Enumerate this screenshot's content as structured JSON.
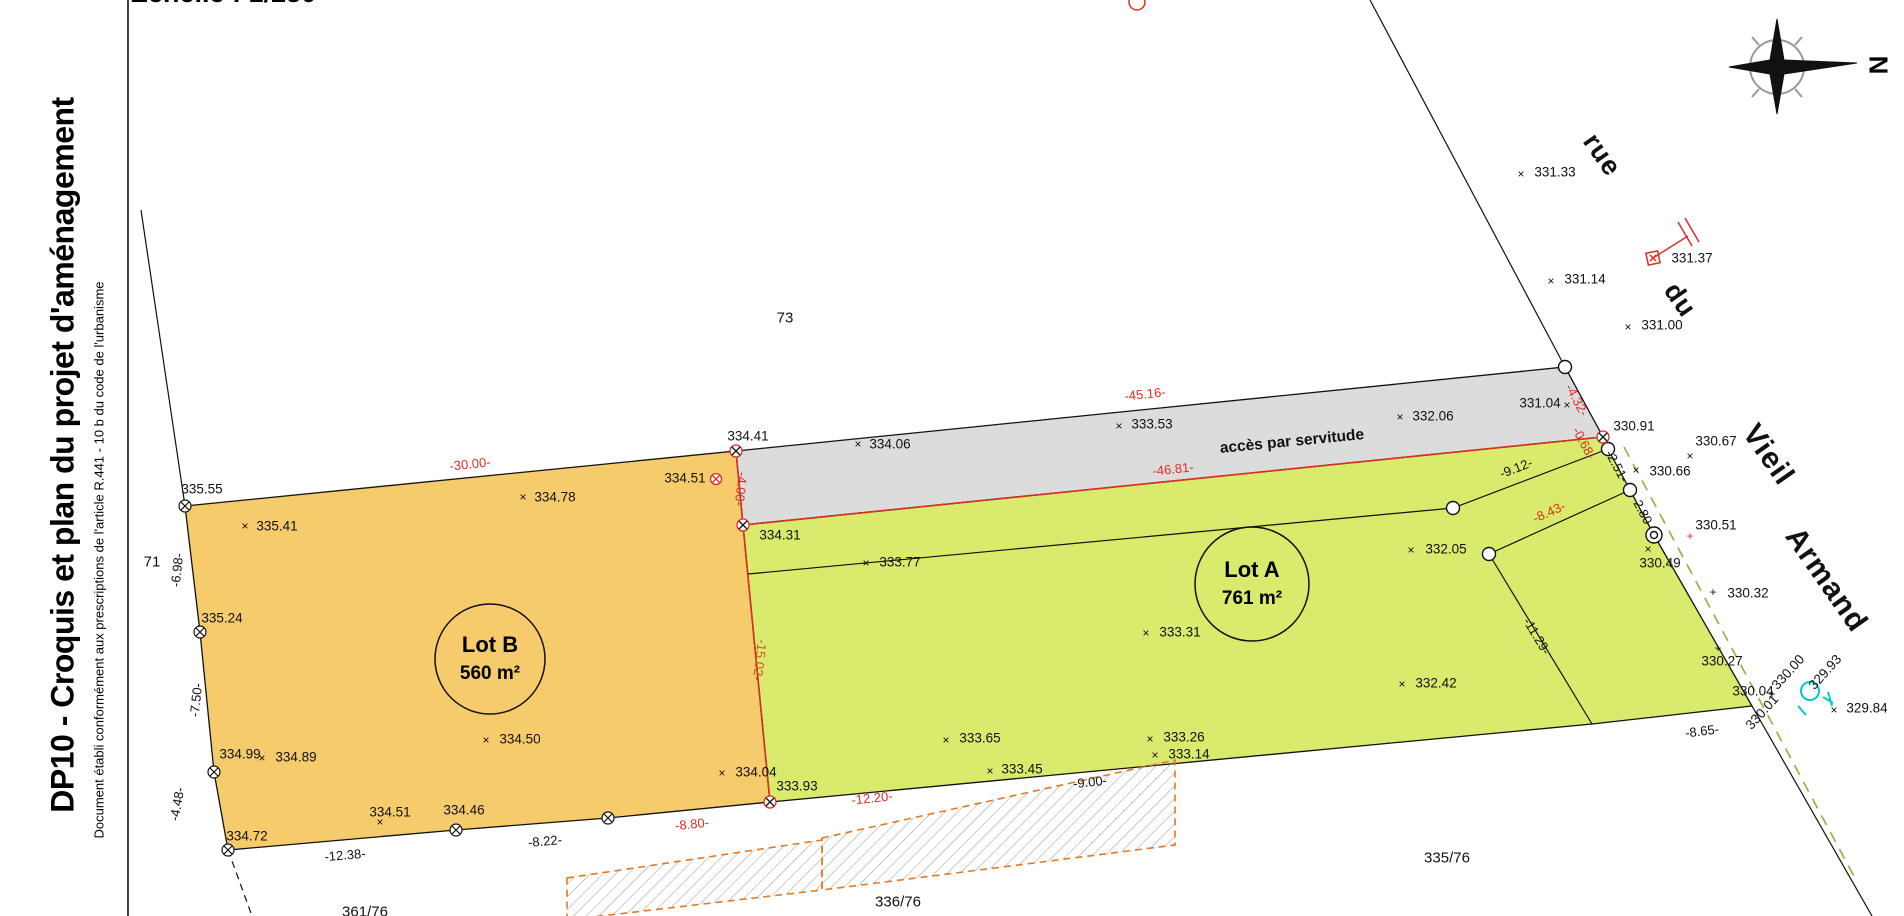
{
  "title_block": {
    "title": "DP10 - Croquis et plan du projet d'aménagement",
    "subtitle": "Document établi conformément aux prescriptions de l'article R.441 - 10 b du code de l'urbanisme",
    "scale_label": "Echelle : 1/250"
  },
  "compass": {
    "north_label": "N"
  },
  "lots": {
    "a": {
      "name": "Lot A",
      "area": "761 m²"
    },
    "b": {
      "name": "Lot B",
      "area": "560 m²"
    }
  },
  "colors": {
    "lot_a_fill": "#d9ea6c",
    "lot_b_fill": "#f6cb6c",
    "servitude_fill": "#dcdcdc",
    "boundary_red": "#d93025",
    "dim_orange_red": "#d4581e",
    "dashed_olive": "#a8a94f",
    "hatch_border_orange": "#e87722",
    "utility_cyan": "#00c8d7"
  },
  "labels": [
    {
      "t": "accès par servitude",
      "x": 1292,
      "y": 442,
      "r": -5.5,
      "c": "acces"
    },
    {
      "t": "73",
      "x": 785,
      "y": 318,
      "c": "parcel"
    },
    {
      "t": "71",
      "x": 152,
      "y": 562,
      "c": "parcel"
    },
    {
      "t": "335/76",
      "x": 1447,
      "y": 858,
      "c": "parcel"
    },
    {
      "t": "336/76",
      "x": 898,
      "y": 902,
      "c": "parcel"
    },
    {
      "t": "361/76",
      "x": 365,
      "y": 912,
      "c": "parcel"
    },
    {
      "t": "rue",
      "x": 1602,
      "y": 155,
      "r": 55,
      "c": "street"
    },
    {
      "t": "du",
      "x": 1680,
      "y": 300,
      "r": 55,
      "c": "street"
    },
    {
      "t": "Vieil",
      "x": 1768,
      "y": 455,
      "r": 55,
      "c": "street2"
    },
    {
      "t": "Armand",
      "x": 1826,
      "y": 580,
      "r": 55,
      "c": "street2"
    },
    {
      "t": "335.55",
      "x": 202,
      "y": 489,
      "c": "pt"
    },
    {
      "t": "335.41",
      "x": 277,
      "y": 526,
      "c": "pt"
    },
    {
      "t": "334.78",
      "x": 555,
      "y": 497,
      "c": "pt"
    },
    {
      "t": "334.51",
      "x": 685,
      "y": 478,
      "c": "pt"
    },
    {
      "t": "334.41",
      "x": 748,
      "y": 436,
      "c": "pt"
    },
    {
      "t": "334.06",
      "x": 890,
      "y": 444,
      "c": "pt"
    },
    {
      "t": "333.53",
      "x": 1152,
      "y": 424,
      "c": "pt"
    },
    {
      "t": "332.06",
      "x": 1433,
      "y": 416,
      "c": "pt"
    },
    {
      "t": "331.04",
      "x": 1540,
      "y": 403,
      "c": "pt"
    },
    {
      "t": "330.91",
      "x": 1634,
      "y": 426,
      "c": "pt"
    },
    {
      "t": "331.33",
      "x": 1555,
      "y": 172,
      "c": "pt"
    },
    {
      "t": "331.14",
      "x": 1585,
      "y": 279,
      "c": "pt"
    },
    {
      "t": "331.00",
      "x": 1662,
      "y": 325,
      "c": "pt"
    },
    {
      "t": "331.37",
      "x": 1692,
      "y": 258,
      "c": "pt"
    },
    {
      "t": "330.67",
      "x": 1716,
      "y": 441,
      "c": "pt"
    },
    {
      "t": "330.66",
      "x": 1670,
      "y": 471,
      "c": "pt"
    },
    {
      "t": "330.51",
      "x": 1716,
      "y": 525,
      "c": "pt"
    },
    {
      "t": "330.49",
      "x": 1660,
      "y": 563,
      "c": "pt"
    },
    {
      "t": "330.32",
      "x": 1748,
      "y": 593,
      "c": "pt"
    },
    {
      "t": "330.27",
      "x": 1722,
      "y": 661,
      "c": "pt"
    },
    {
      "t": "330.00",
      "x": 1788,
      "y": 672,
      "r": -48,
      "c": "pt"
    },
    {
      "t": "329.93",
      "x": 1825,
      "y": 672,
      "r": -48,
      "c": "pt"
    },
    {
      "t": "330.04",
      "x": 1753,
      "y": 691,
      "c": "pt"
    },
    {
      "t": "330.01",
      "x": 1762,
      "y": 712,
      "r": -48,
      "c": "pt"
    },
    {
      "t": "329.84",
      "x": 1867,
      "y": 708,
      "c": "pt"
    },
    {
      "t": "334.31",
      "x": 780,
      "y": 535,
      "c": "pt"
    },
    {
      "t": "333.77",
      "x": 900,
      "y": 562,
      "c": "pt"
    },
    {
      "t": "333.31",
      "x": 1180,
      "y": 632,
      "c": "pt"
    },
    {
      "t": "332.05",
      "x": 1446,
      "y": 549,
      "c": "pt"
    },
    {
      "t": "332.42",
      "x": 1436,
      "y": 683,
      "c": "pt"
    },
    {
      "t": "333.65",
      "x": 980,
      "y": 738,
      "c": "pt"
    },
    {
      "t": "333.45",
      "x": 1022,
      "y": 769,
      "c": "pt"
    },
    {
      "t": "333.26",
      "x": 1184,
      "y": 737,
      "c": "pt"
    },
    {
      "t": "333.14",
      "x": 1189,
      "y": 754,
      "c": "pt"
    },
    {
      "t": "333.93",
      "x": 797,
      "y": 786,
      "c": "pt"
    },
    {
      "t": "334.04",
      "x": 756,
      "y": 772,
      "c": "pt"
    },
    {
      "t": "334.50",
      "x": 520,
      "y": 739,
      "c": "pt"
    },
    {
      "t": "335.24",
      "x": 222,
      "y": 618,
      "c": "pt"
    },
    {
      "t": "334.99",
      "x": 240,
      "y": 754,
      "c": "pt"
    },
    {
      "t": "334.89",
      "x": 296,
      "y": 757,
      "c": "pt"
    },
    {
      "t": "334.72",
      "x": 247,
      "y": 836,
      "c": "pt"
    },
    {
      "t": "334.51",
      "x": 390,
      "y": 812,
      "c": "pt"
    },
    {
      "t": "334.46",
      "x": 464,
      "y": 810,
      "c": "pt"
    },
    {
      "t": "-30.00-",
      "x": 470,
      "y": 464,
      "r": -6,
      "c": "dimr"
    },
    {
      "t": "-45.16-",
      "x": 1145,
      "y": 394,
      "r": -6,
      "c": "dimr"
    },
    {
      "t": "-46.81-",
      "x": 1173,
      "y": 469,
      "r": -6,
      "c": "dimr"
    },
    {
      "t": "-4.00-",
      "x": 741,
      "y": 489,
      "r": 96,
      "c": "dimr"
    },
    {
      "t": "-15.02-",
      "x": 760,
      "y": 660,
      "r": 97,
      "c": "dimo"
    },
    {
      "t": "-4.32-",
      "x": 1577,
      "y": 400,
      "r": 62,
      "c": "dimr"
    },
    {
      "t": "-0.68-",
      "x": 1584,
      "y": 443,
      "r": 62,
      "c": "dimr"
    },
    {
      "t": "-8.43-",
      "x": 1549,
      "y": 512,
      "r": -24,
      "c": "dimr"
    },
    {
      "t": "-12.20-",
      "x": 872,
      "y": 798,
      "r": -6,
      "c": "dimr"
    },
    {
      "t": "-8.80-",
      "x": 692,
      "y": 824,
      "r": -6,
      "c": "dimr"
    },
    {
      "t": "-6.98-",
      "x": 177,
      "y": 570,
      "r": -84,
      "c": "dim"
    },
    {
      "t": "-7.50-",
      "x": 196,
      "y": 700,
      "r": -84,
      "c": "dim"
    },
    {
      "t": "-4.48-",
      "x": 177,
      "y": 804,
      "r": -80,
      "c": "dim"
    },
    {
      "t": "-12.38-",
      "x": 345,
      "y": 855,
      "r": -5,
      "c": "dim"
    },
    {
      "t": "-8.22-",
      "x": 545,
      "y": 841,
      "r": -5,
      "c": "dim"
    },
    {
      "t": "-9.12-",
      "x": 1516,
      "y": 468,
      "r": -21,
      "c": "dim"
    },
    {
      "t": "-2.51-",
      "x": 1617,
      "y": 466,
      "r": 62,
      "c": "dim"
    },
    {
      "t": "-2.80-",
      "x": 1643,
      "y": 512,
      "r": 62,
      "c": "dim"
    },
    {
      "t": "-11.29-",
      "x": 1537,
      "y": 636,
      "r": 59,
      "c": "dim"
    },
    {
      "t": "-8.65-",
      "x": 1702,
      "y": 731,
      "r": -7,
      "c": "dim"
    },
    {
      "t": "-9.00-",
      "x": 1090,
      "y": 782,
      "r": -6,
      "c": "dim"
    }
  ],
  "markers": [
    {
      "t": "×",
      "x": 245,
      "y": 526,
      "c": "mk"
    },
    {
      "t": "×",
      "x": 523,
      "y": 497,
      "c": "mk"
    },
    {
      "t": "×",
      "x": 858,
      "y": 444,
      "c": "mk"
    },
    {
      "t": "×",
      "x": 1119,
      "y": 426,
      "c": "mk"
    },
    {
      "t": "×",
      "x": 1400,
      "y": 417,
      "c": "mk"
    },
    {
      "t": "×",
      "x": 1567,
      "y": 405,
      "c": "mk"
    },
    {
      "t": "×",
      "x": 1521,
      "y": 174,
      "c": "mk"
    },
    {
      "t": "×",
      "x": 1551,
      "y": 281,
      "c": "mk"
    },
    {
      "t": "×",
      "x": 1628,
      "y": 327,
      "c": "mk"
    },
    {
      "t": "×",
      "x": 1690,
      "y": 456,
      "c": "mk"
    },
    {
      "t": "×",
      "x": 1636,
      "y": 470,
      "c": "mk"
    },
    {
      "t": "×",
      "x": 1648,
      "y": 549,
      "c": "mk"
    },
    {
      "t": "×",
      "x": 1834,
      "y": 710,
      "c": "mk"
    },
    {
      "t": "×",
      "x": 866,
      "y": 563,
      "c": "mk"
    },
    {
      "t": "×",
      "x": 1146,
      "y": 633,
      "c": "mk"
    },
    {
      "t": "×",
      "x": 1411,
      "y": 550,
      "c": "mk"
    },
    {
      "t": "×",
      "x": 1402,
      "y": 684,
      "c": "mk"
    },
    {
      "t": "×",
      "x": 946,
      "y": 740,
      "c": "mk"
    },
    {
      "t": "×",
      "x": 990,
      "y": 771,
      "c": "mk"
    },
    {
      "t": "×",
      "x": 1150,
      "y": 739,
      "c": "mk"
    },
    {
      "t": "×",
      "x": 1155,
      "y": 755,
      "c": "mk"
    },
    {
      "t": "×",
      "x": 722,
      "y": 773,
      "c": "mk"
    },
    {
      "t": "×",
      "x": 486,
      "y": 740,
      "c": "mk"
    },
    {
      "t": "×",
      "x": 262,
      "y": 758,
      "c": "mk"
    },
    {
      "t": "×",
      "x": 380,
      "y": 822,
      "c": "mk"
    },
    {
      "t": "+",
      "x": 1713,
      "y": 592,
      "c": "mk"
    },
    {
      "t": "+",
      "x": 1718,
      "y": 648,
      "c": "mk"
    },
    {
      "t": "+",
      "x": 1772,
      "y": 694,
      "c": "mk"
    },
    {
      "t": "+",
      "x": 1690,
      "y": 536,
      "c": "mkr"
    }
  ]
}
